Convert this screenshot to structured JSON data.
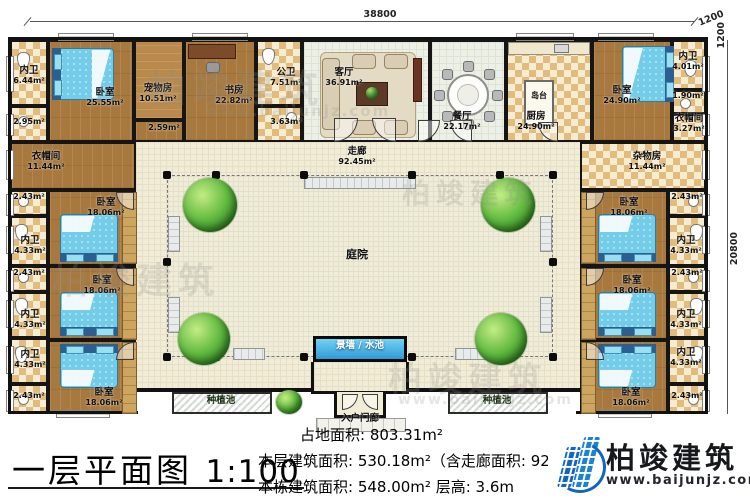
{
  "meta": {
    "title": "一层平面图",
    "scale": "1:100"
  },
  "dimensions": {
    "top": "38800",
    "right": "20800",
    "corner_a": "1200",
    "corner_b": "1200"
  },
  "stats": {
    "land_area": "占地面积: 803.31m²",
    "floor_area": "本层建筑面积: 530.18m²（含走廊面积: 92.45m²）",
    "building_area": "本栋建筑面积: 548.00m² 层高: 3.6m"
  },
  "logo": {
    "name": "柏竣建筑",
    "url": "www.baijunjz.com"
  },
  "watermark": {
    "text": "柏竣建筑",
    "url": "www.baijunjz.com"
  },
  "colors": {
    "wall": "#151515",
    "wood": "#a8793e",
    "tile": "#e2bc7d",
    "water": "#3aa0dc",
    "grass": "#3f9b35",
    "courtyard": "#efecd8",
    "logo_blue": "#1565c0"
  },
  "rooms": [
    {
      "label": "内卫",
      "area": "6.44m²"
    },
    {
      "label": "",
      "area": "2.95m²"
    },
    {
      "label": "卧室",
      "area": "25.55m²"
    },
    {
      "label": "宠物房",
      "area": "10.51m²"
    },
    {
      "label": "",
      "area": "2.59m²"
    },
    {
      "label": "书房",
      "area": "22.82m²"
    },
    {
      "label": "公卫",
      "area": "7.51m²"
    },
    {
      "label": "",
      "area": "3.63m²"
    },
    {
      "label": "客厅",
      "area": "36.91m²"
    },
    {
      "label": "餐厅",
      "area": "22.17m²"
    },
    {
      "label": "厨房",
      "area": "24.90m²"
    },
    {
      "label": "卧室",
      "area": "24.90m²"
    },
    {
      "label": "内卫",
      "area": "4.01m²"
    },
    {
      "label": "",
      "area": "1.90m²"
    },
    {
      "label": "衣帽间",
      "area": "3.27m²"
    },
    {
      "label": "衣帽间",
      "area": "11.44m²"
    },
    {
      "label": "",
      "area": "2.43m²"
    },
    {
      "label": "内卫",
      "area": "4.33m²"
    },
    {
      "label": "卧室",
      "area": "18.06m²"
    },
    {
      "label": "",
      "area": "2.43m²"
    },
    {
      "label": "内卫",
      "area": "4.33m²"
    },
    {
      "label": "卧室",
      "area": "18.06m²"
    },
    {
      "label": "内卫",
      "area": "4.33m²"
    },
    {
      "label": "",
      "area": "2.43m²"
    },
    {
      "label": "卧室",
      "area": "18.06m²"
    },
    {
      "label": "杂物房",
      "area": "11.44m²"
    },
    {
      "label": "",
      "area": "2.43m²"
    },
    {
      "label": "内卫",
      "area": "4.33m²"
    },
    {
      "label": "卧室",
      "area": "18.06m²"
    },
    {
      "label": "",
      "area": "2.43m²"
    },
    {
      "label": "内卫",
      "area": "4.33m²"
    },
    {
      "label": "卧室",
      "area": "18.06m²"
    },
    {
      "label": "内卫",
      "area": "4.33m²"
    },
    {
      "label": "",
      "area": "2.43m²"
    },
    {
      "label": "卧室",
      "area": "18.06m²"
    },
    {
      "label": "走廊",
      "area": "92.45m²"
    },
    {
      "label": "庭院",
      "area": ""
    },
    {
      "label": "景墙 / 水池",
      "area": ""
    },
    {
      "label": "入户门廊",
      "area": ""
    },
    {
      "label": "种植池",
      "area": ""
    },
    {
      "label": "种植池",
      "area": ""
    },
    {
      "label": "岛台",
      "area": ""
    }
  ]
}
